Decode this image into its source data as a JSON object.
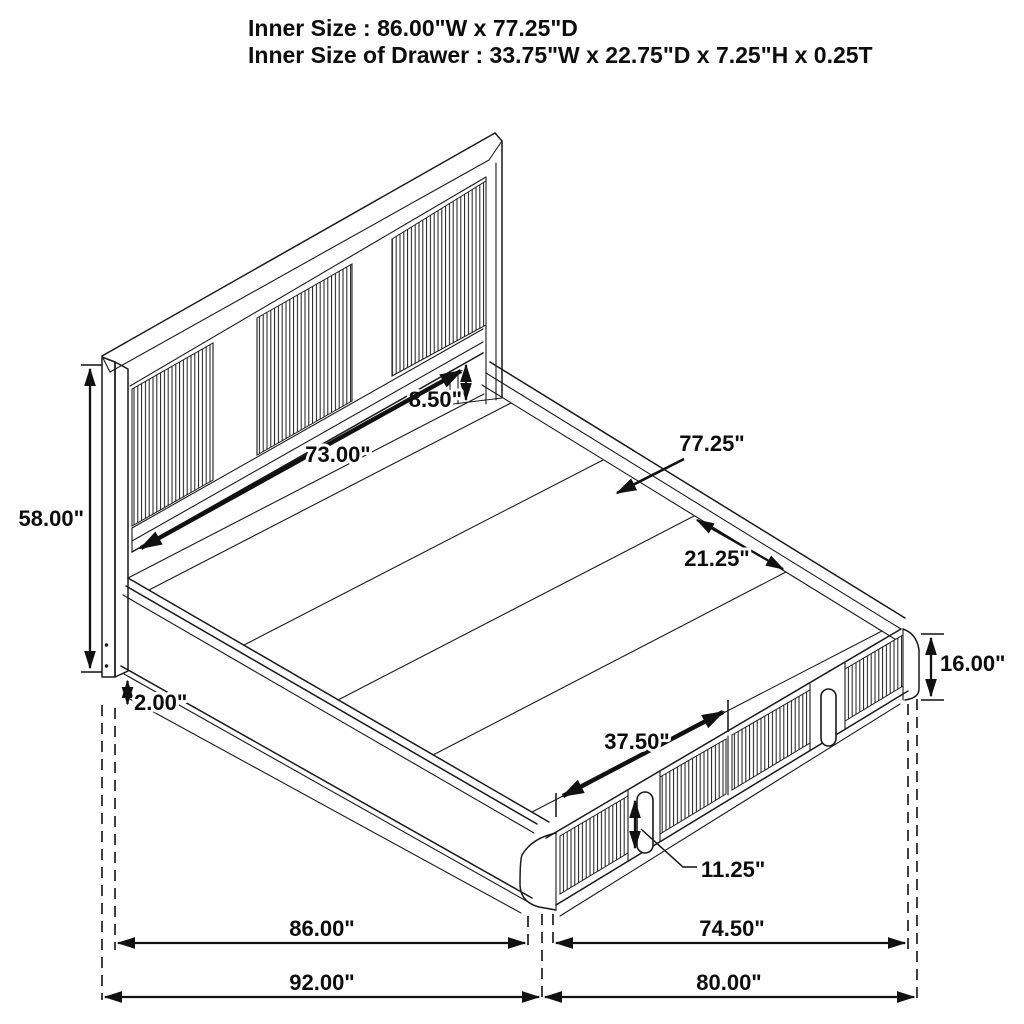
{
  "title": {
    "line1": "Inner Size : 86.00\"W x 77.25\"D",
    "line2": "Inner Size of Drawer : 33.75\"W x 22.75\"D x 7.25\"H x 0.25T"
  },
  "dims": {
    "hb_rail_gap": "8.50\"",
    "hb_inner_width": "73.00\"",
    "inner_depth": "77.25\"",
    "plank_width": "21.25\"",
    "hb_height": "58.00\"",
    "base_height": "16.00\"",
    "base_clearance": "2.00\"",
    "drawer_front_width": "37.50\"",
    "handle_height": "11.25\"",
    "inner_width": "86.00\"",
    "overall_width": "92.00\"",
    "foot_inner_width": "74.50\"",
    "overall_depth": "80.00\""
  },
  "colors": {
    "line": "#1a1a1a",
    "background": "#ffffff"
  }
}
